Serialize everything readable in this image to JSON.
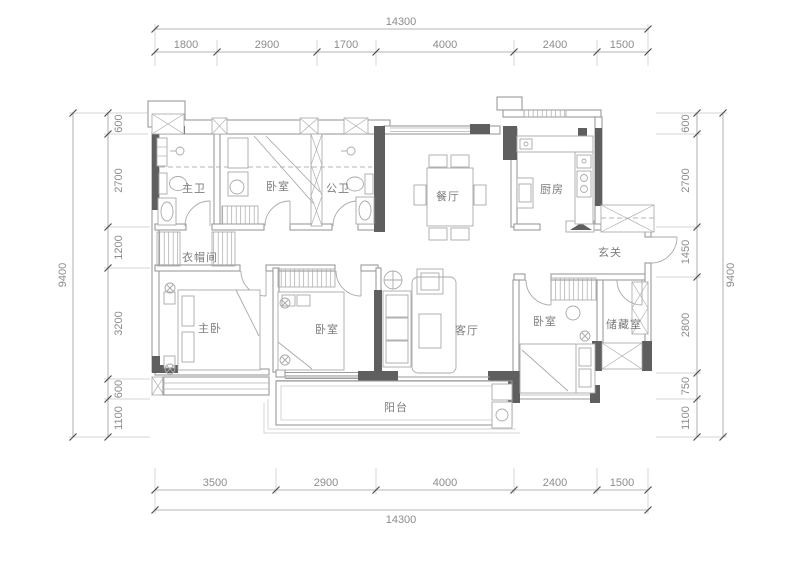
{
  "rooms": {
    "master_bath": "主卫",
    "bedroom_top": "卧室",
    "public_bath": "公卫",
    "dining": "餐厅",
    "kitchen": "厨房",
    "entry": "玄关",
    "cloakroom": "衣帽间",
    "master_bedroom": "主卧",
    "bedroom_mid": "卧室",
    "living": "客厅",
    "bedroom_right": "卧室",
    "storage": "储藏室",
    "balcony": "阳台"
  },
  "dims": {
    "top": {
      "total": "14300",
      "segments": [
        "1800",
        "2900",
        "1700",
        "4000",
        "2400",
        "1500"
      ]
    },
    "bottom": {
      "total": "14300",
      "segments": [
        "3500",
        "2900",
        "4000",
        "2400",
        "1500"
      ]
    },
    "left": {
      "total": "9400",
      "segments": [
        "600",
        "2700",
        "1200",
        "3200",
        "600",
        "1100"
      ]
    },
    "right": {
      "total": "9400",
      "segments": [
        "600",
        "2700",
        "1450",
        "2800",
        "750",
        "1100"
      ]
    }
  },
  "colors": {
    "wall_dark": "#5f5f5f",
    "line": "#9b9b9b",
    "text": "#8c8c8c"
  }
}
